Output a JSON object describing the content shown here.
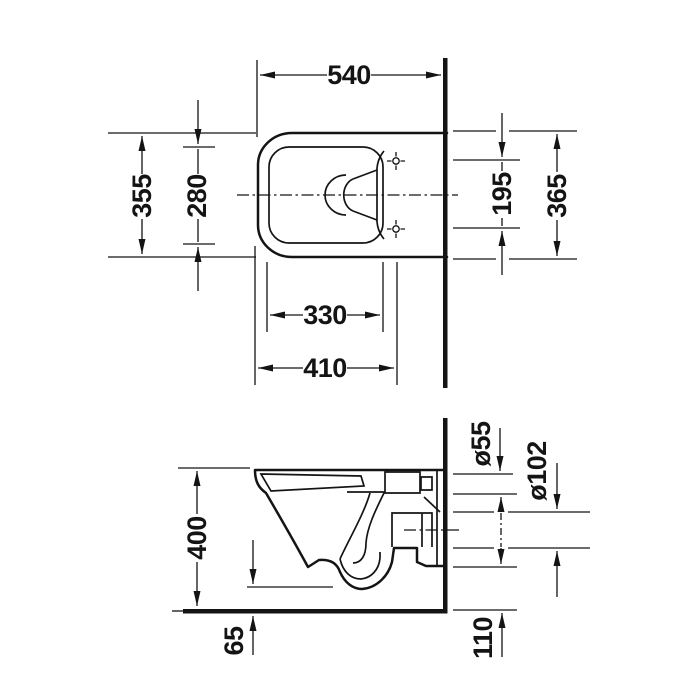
{
  "colors": {
    "line": "#141414",
    "background": "#ffffff"
  },
  "top_view": {
    "dims": {
      "d540": "540",
      "d355": "355",
      "d280": "280",
      "d195": "195",
      "d365": "365",
      "d330": "330",
      "d410": "410"
    }
  },
  "side_view": {
    "dims": {
      "d400": "400",
      "d55": "ø55",
      "d102": "ø102",
      "d65": "65",
      "d110": "110"
    }
  }
}
